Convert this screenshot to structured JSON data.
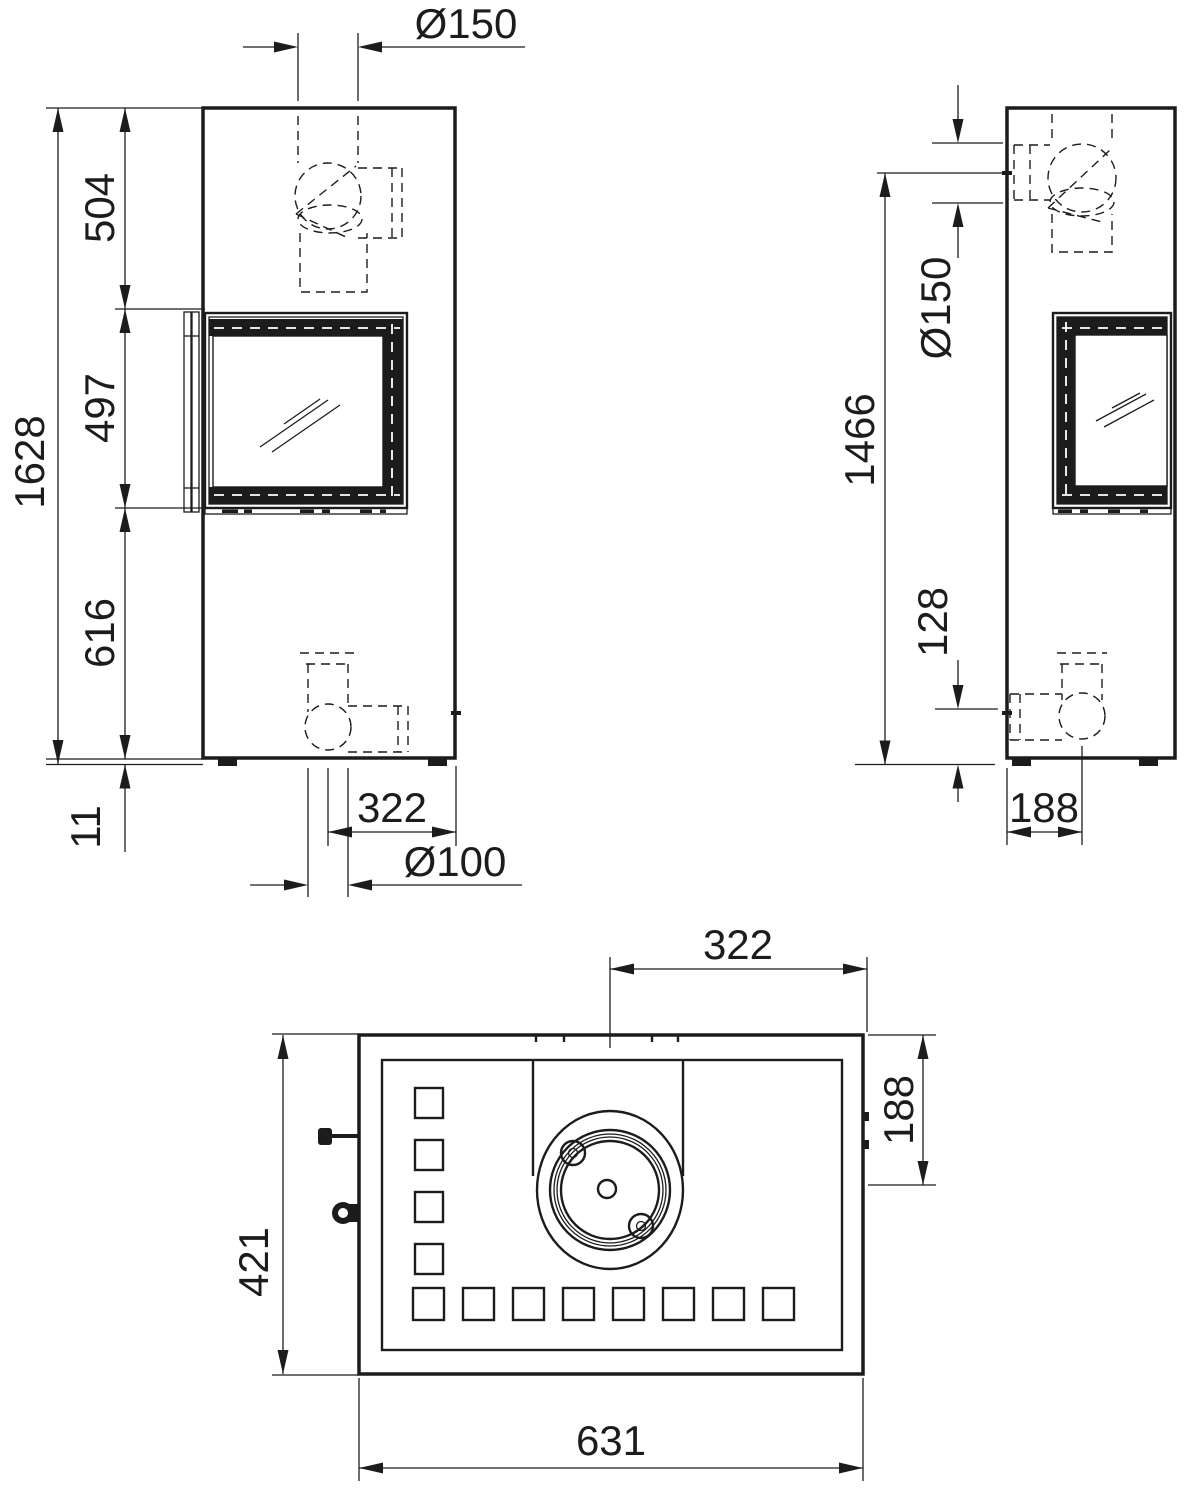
{
  "colors": {
    "line": "#1c1c1c",
    "background": "#ffffff"
  },
  "drawing": {
    "kind": "stove-dimension-drawing",
    "front_view": {
      "dims": {
        "flue_diameter_top": "Ø150",
        "overall_height": "1628",
        "top_to_window": "504",
        "window_height": "497",
        "window_to_base": "616",
        "base_clearance": "11",
        "outlet_offset_horizontal": "322",
        "air_inlet_diameter": "Ø100"
      }
    },
    "side_view": {
      "dims": {
        "rear_outlet_height": "1466",
        "flue_diameter_rear": "Ø150",
        "air_inlet_axis_height": "128",
        "outlet_offset_depth": "188"
      }
    },
    "top_view": {
      "dims": {
        "flue_offset_from_right": "322",
        "flue_offset_from_back": "188",
        "depth": "421",
        "width": "631"
      }
    }
  }
}
